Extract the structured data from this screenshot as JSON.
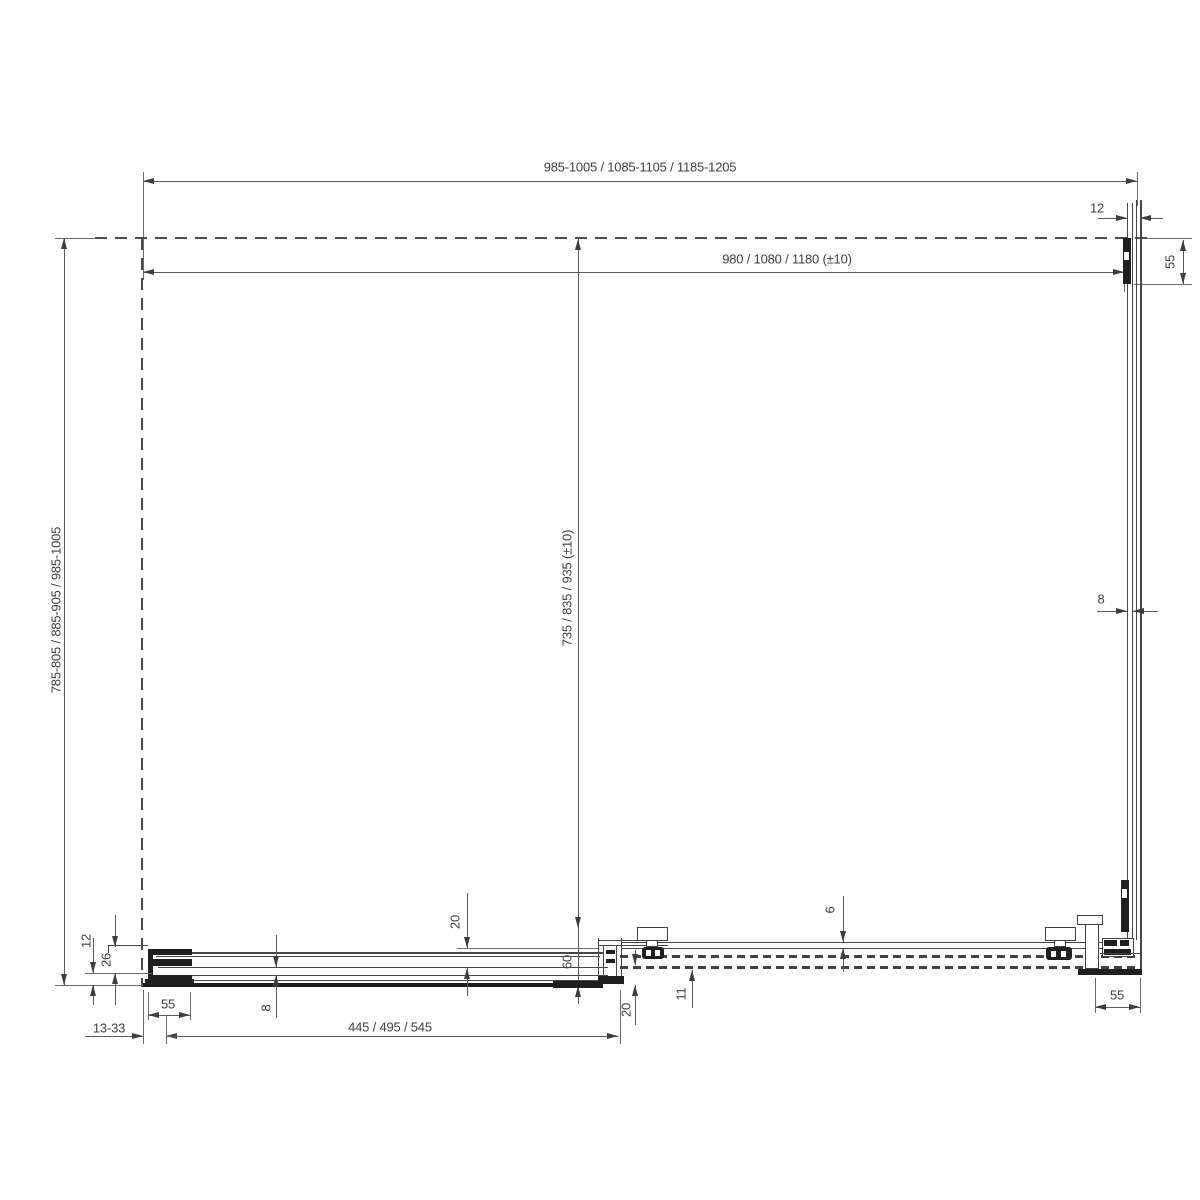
{
  "drawing": {
    "type": "shower-enclosure-plan-view",
    "dims": {
      "width_overall": "985-1005 / 1085-1105 / 1185-1205",
      "width_glass": "980 / 1080 / 1180 (±10)",
      "wall_profile_offset": "12",
      "wall_bracket_top_right": "55",
      "depth_overall": "785-805 / 885-905 / 985-1005",
      "depth_glass": "735 / 835 / 935 (±10)",
      "side_glass_thickness": "8",
      "bottom_profile_height": "12",
      "bottom_profile_depth": "26",
      "wall_bracket_bottom_left": "55",
      "adjustment_range": "13-33",
      "fixed_glass_thickness": "8",
      "fixed_panel_length": "445 / 495 / 545",
      "panel_gap": "20",
      "overlap": "60",
      "bottom_gap": "20",
      "rail_offset": "11",
      "door_glass_thickness": "6",
      "wall_bracket_bottom_right": "55"
    }
  }
}
